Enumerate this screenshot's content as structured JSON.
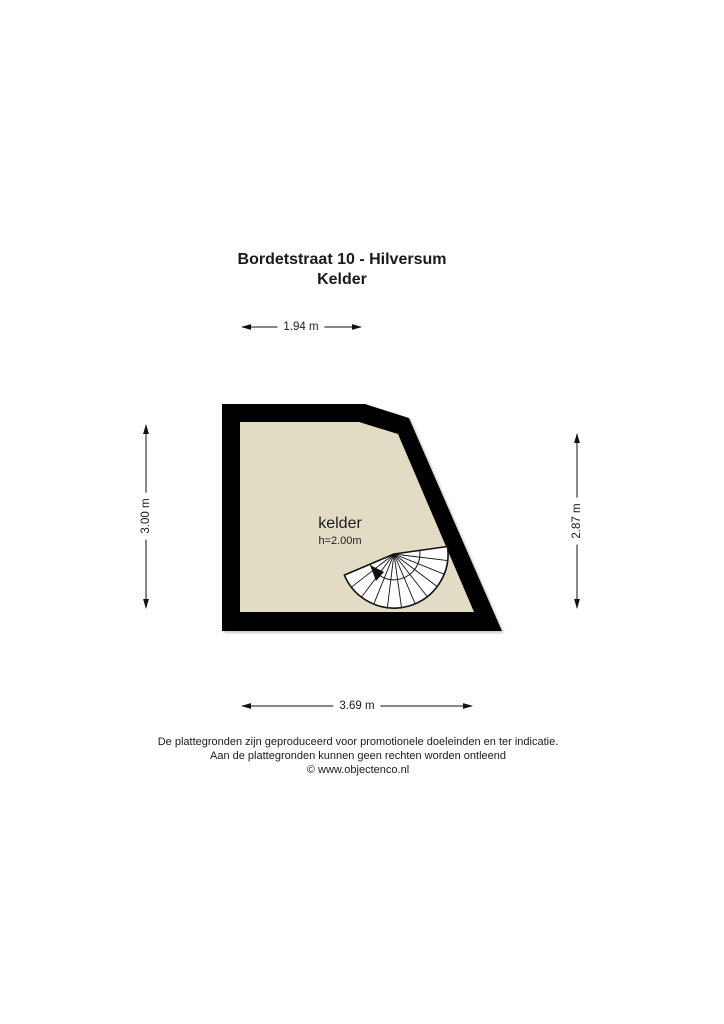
{
  "title": {
    "line1": "Bordetstraat 10 - Hilversum",
    "line2": "Kelder"
  },
  "room": {
    "name": "kelder",
    "height": "h=2.00m"
  },
  "dimensions": {
    "top": "1.94 m",
    "left": "3.00 m",
    "right": "2.87 m",
    "bottom": "3.69 m"
  },
  "footer": {
    "line1": "De plattegronden zijn geproduceerd voor promotionele doeleinden en ter indicatie.",
    "line2": "Aan de plattegronden kunnen geen rechten worden ontleend",
    "line3": "© www.objectenco.nl"
  },
  "colors": {
    "wall": "#000000",
    "floor_fill": "#e2dcc5",
    "stair_fill": "#ffffff",
    "line": "#111111",
    "text": "#1a1a1a"
  }
}
